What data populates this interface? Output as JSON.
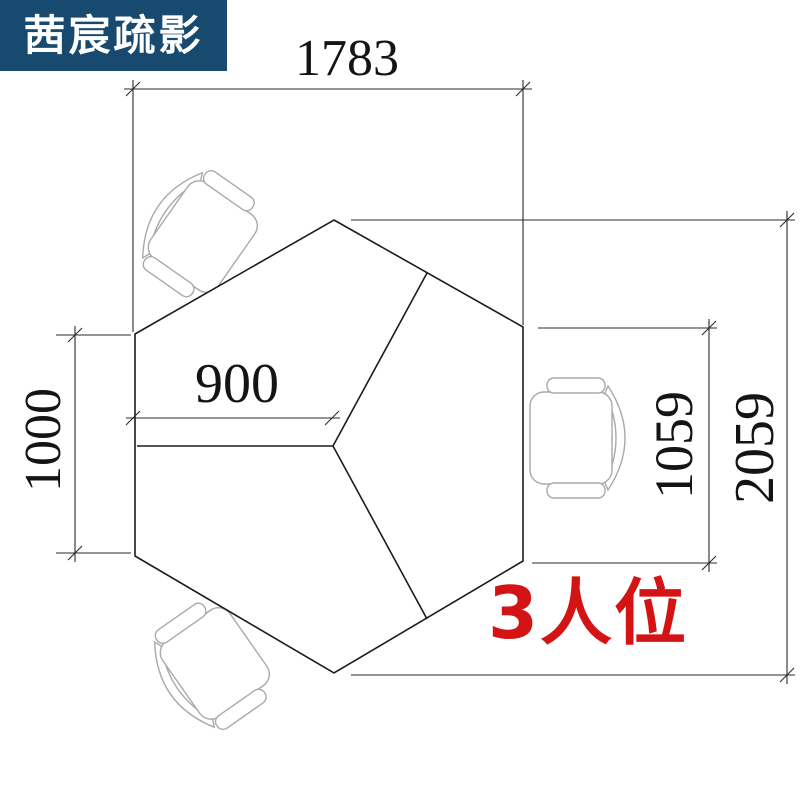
{
  "logo": {
    "text": "茜宸疏影",
    "bg_color": "#174a6e",
    "text_color": "#ffffff"
  },
  "plan": {
    "label": {
      "text": "3人位",
      "color": "#d41414"
    },
    "dimensions": {
      "top_width": "1783",
      "left_height": "1000",
      "desk_depth": "900",
      "right_side_height": "1059",
      "overall_height": "2059"
    },
    "colors": {
      "desk_outline": "#1c1c1c",
      "dimension_line": "#2b2b2b",
      "chair_outline": "#a9a9a9"
    }
  }
}
